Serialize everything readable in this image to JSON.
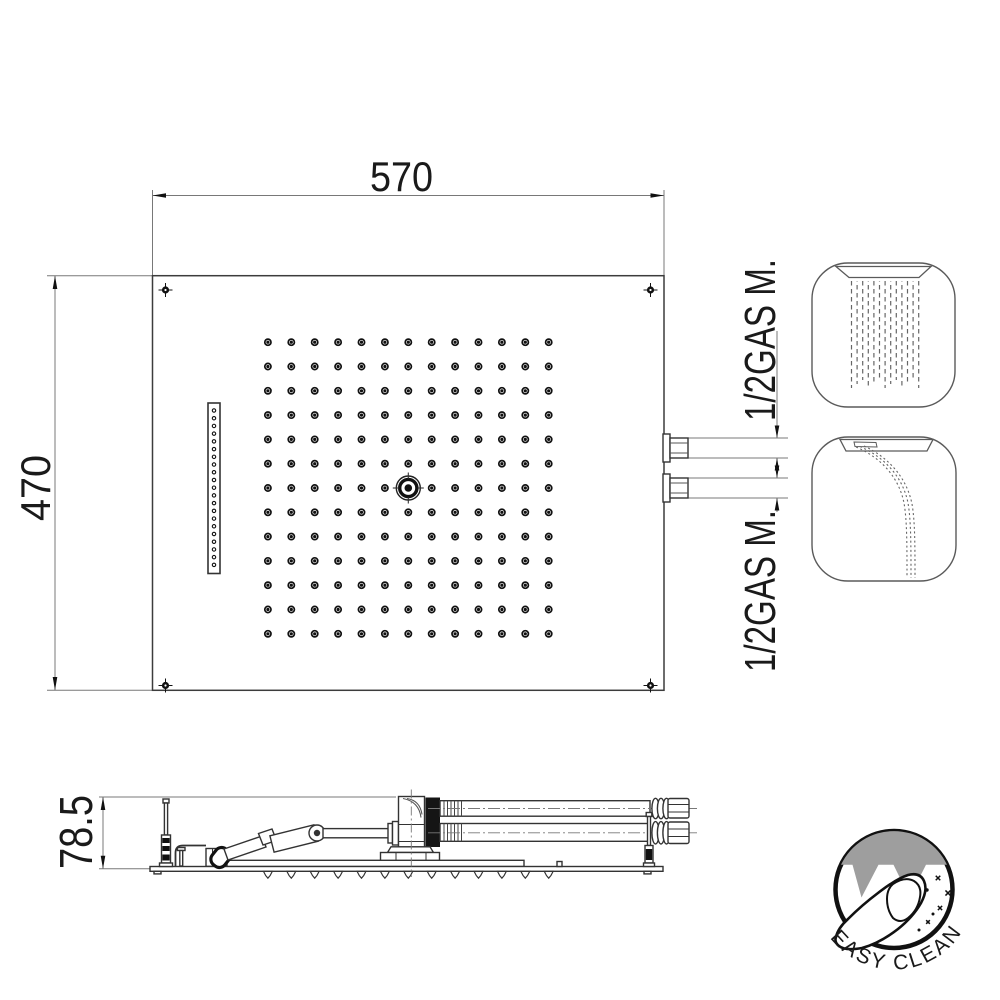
{
  "drawing": {
    "type": "shower-head technical drawing",
    "top_view": {
      "width_label": "570",
      "height_label": "470",
      "connection_label_top": "1/2GAS M.",
      "connection_label_bottom": "1/2GAS M.",
      "nozzle_grid": {
        "cols": 13,
        "rows": 13,
        "x0": 267.9,
        "y0": 342.2,
        "dx": 23.4,
        "dy": 24.3,
        "outer_r": 3.1,
        "dot_r": 1.6,
        "center_col": 6,
        "center_row": 6
      },
      "slot": {
        "x": 208,
        "y": 403,
        "w": 12,
        "h": 170.5,
        "holes": 21,
        "hole_cx": 214,
        "hole_y0": 410.5,
        "hole_dy": 7.72,
        "hole_r": 1.7
      },
      "screws": {
        "r": 3.6,
        "positions": [
          [
            165.5,
            290
          ],
          [
            650.5,
            290
          ],
          [
            165.5,
            685.5
          ],
          [
            650.5,
            685.5
          ]
        ]
      }
    },
    "side_view": {
      "height_label": "78.5",
      "teeth": {
        "count": 13,
        "x0": 267.9,
        "dx": 23.4,
        "top": 871.4
      }
    },
    "icons": {
      "rain_mode": {
        "name": "rain-spray-icon",
        "lines": {
          "count": 13,
          "x0": 851.5,
          "dx": 5.6,
          "y0": 281,
          "y1": 388
        }
      },
      "waterfall_mode": {
        "name": "waterfall-spray-icon"
      }
    },
    "logo": {
      "text": "EASY CLEAN"
    },
    "colors": {
      "line": "#3c3c3c",
      "dim_line": "#787878",
      "text": "#1a1a1a",
      "black_fill": "#111111",
      "logo_gray": "#9e9e9e"
    }
  }
}
